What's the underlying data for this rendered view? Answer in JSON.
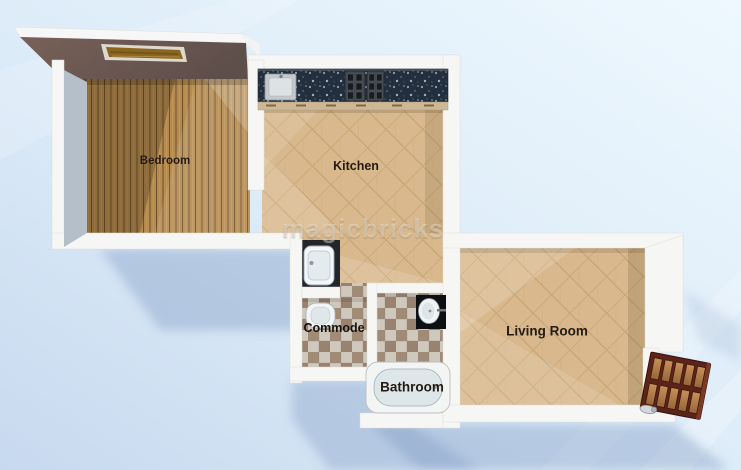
{
  "rooms": {
    "bedroom": {
      "label": "Bedroom",
      "floor": "wooden-planks"
    },
    "kitchen": {
      "label": "Kitchen",
      "floor": "beige-tile",
      "fixtures": [
        "granite-counter",
        "sink",
        "stove",
        "cabinets"
      ]
    },
    "commode": {
      "label": "Commode",
      "floor": "checker-tile",
      "fixtures": [
        "washbasin",
        "toilet"
      ]
    },
    "bathroom": {
      "label": "Bathroom",
      "floor": "checker-tile",
      "fixtures": [
        "washbasin",
        "bathtub"
      ]
    },
    "living_room": {
      "label": "Living Room",
      "floor": "beige-tile",
      "fixtures": [
        "entry-door"
      ]
    }
  },
  "watermark": {
    "text": "magicbricks"
  },
  "colors": {
    "background_light": "#eef8fe",
    "background_mid": "#dcebf8",
    "background_shadow": "#7b95bf",
    "walls": "#f6f7f5",
    "roof_overhang": "#6c5a54",
    "wood_floor": "#b48a4e",
    "beige_tile": "#d8b88c",
    "checker_dark": "#a08b77",
    "checker_light": "#cfc8bc",
    "counter_granite": "#232f3c",
    "door_wood": "#5c2418",
    "label_text": "#241a10"
  }
}
